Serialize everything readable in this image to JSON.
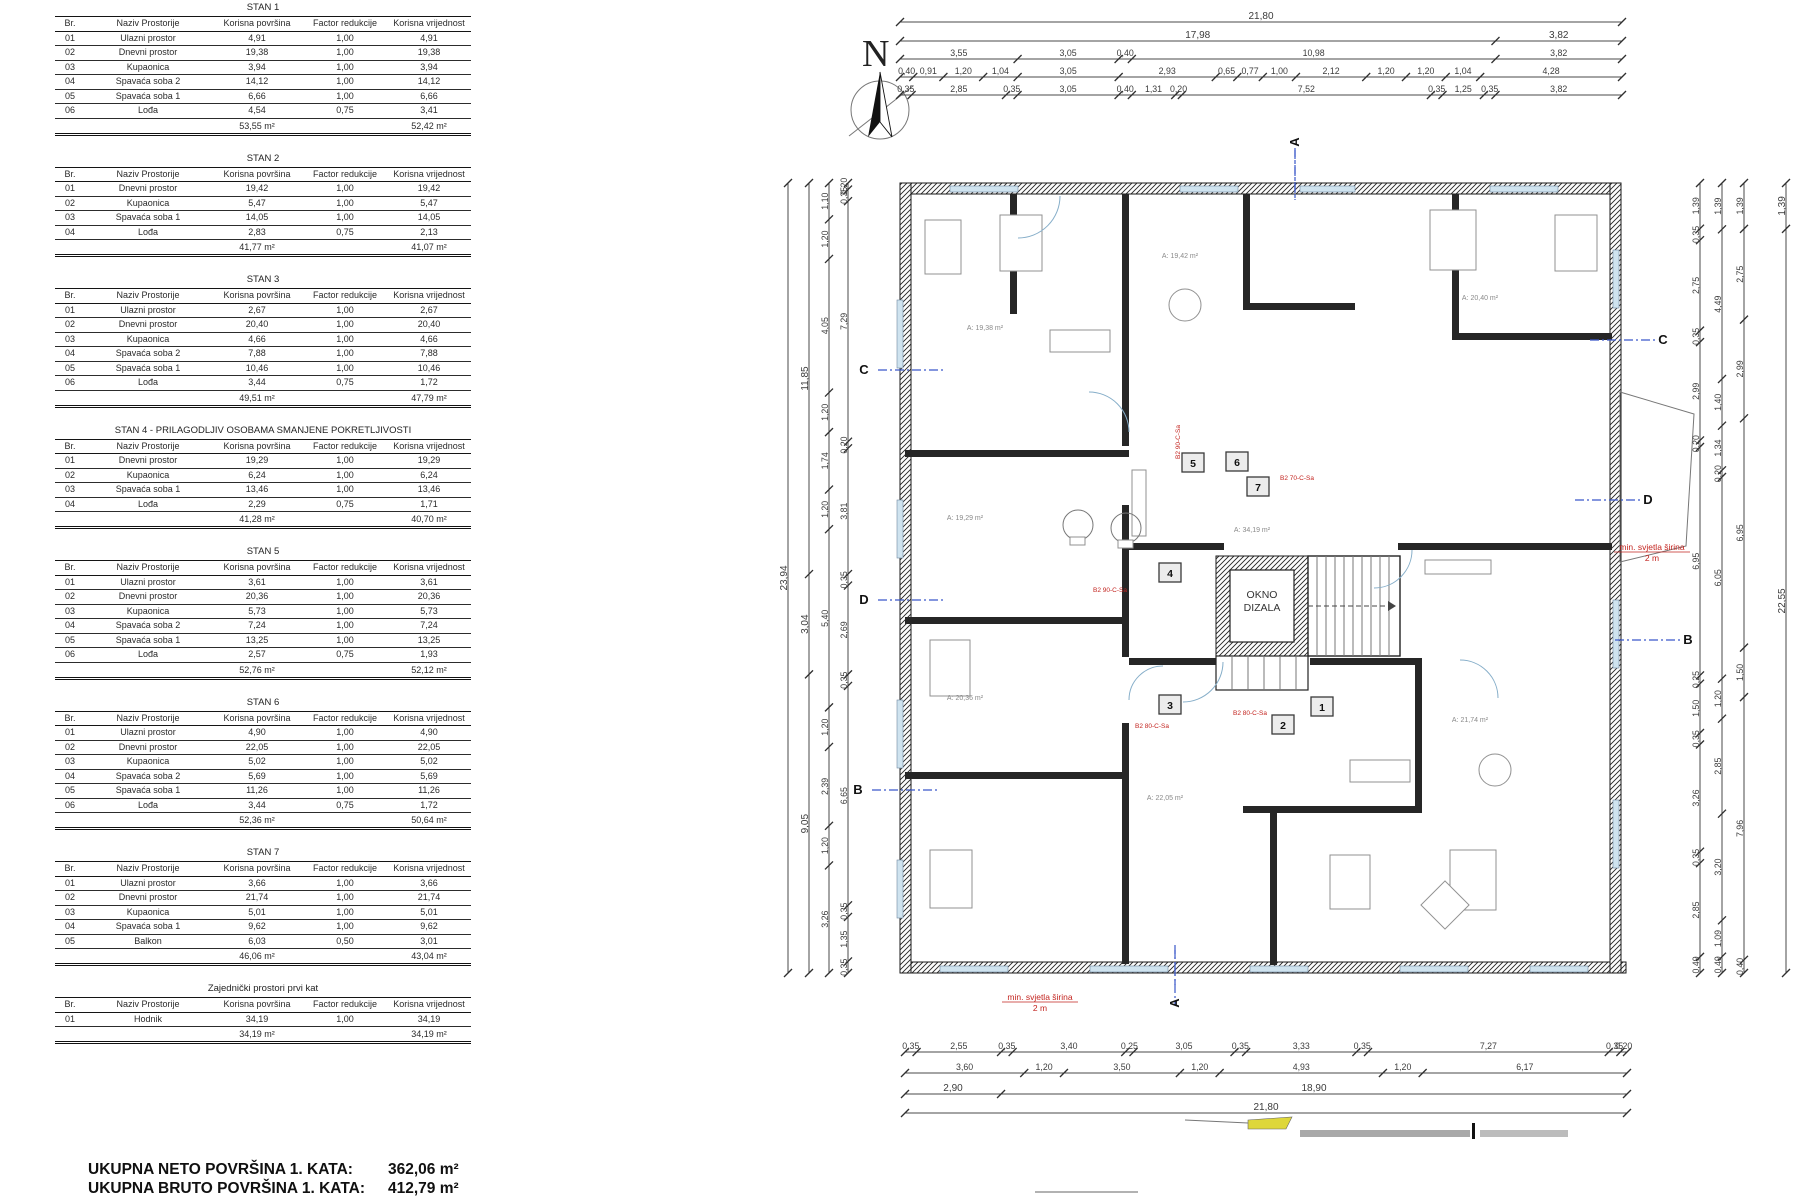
{
  "tables": {
    "headers": [
      "Br.",
      "Naziv Prostorije",
      "Korisna površina",
      "Factor redukcije",
      "Korisna vrijednost"
    ],
    "groups": [
      {
        "title": "STAN 1",
        "rows": [
          [
            "01",
            "Ulazni prostor",
            "4,91",
            "1,00",
            "4,91"
          ],
          [
            "02",
            "Dnevni prostor",
            "19,38",
            "1,00",
            "19,38"
          ],
          [
            "03",
            "Kupaonica",
            "3,94",
            "1,00",
            "3,94"
          ],
          [
            "04",
            "Spavaća soba 2",
            "14,12",
            "1,00",
            "14,12"
          ],
          [
            "05",
            "Spavaća soba 1",
            "6,66",
            "1,00",
            "6,66"
          ],
          [
            "06",
            "Lođa",
            "4,54",
            "0,75",
            "3,41"
          ]
        ],
        "total_area": "53,55 m²",
        "total_value": "52,42 m²"
      },
      {
        "title": "STAN 2",
        "rows": [
          [
            "01",
            "Dnevni prostor",
            "19,42",
            "1,00",
            "19,42"
          ],
          [
            "02",
            "Kupaonica",
            "5,47",
            "1,00",
            "5,47"
          ],
          [
            "03",
            "Spavaća soba 1",
            "14,05",
            "1,00",
            "14,05"
          ],
          [
            "04",
            "Lođa",
            "2,83",
            "0,75",
            "2,13"
          ]
        ],
        "total_area": "41,77 m²",
        "total_value": "41,07 m²"
      },
      {
        "title": "STAN 3",
        "rows": [
          [
            "01",
            "Ulazni prostor",
            "2,67",
            "1,00",
            "2,67"
          ],
          [
            "02",
            "Dnevni prostor",
            "20,40",
            "1,00",
            "20,40"
          ],
          [
            "03",
            "Kupaonica",
            "4,66",
            "1,00",
            "4,66"
          ],
          [
            "04",
            "Spavaća soba 2",
            "7,88",
            "1,00",
            "7,88"
          ],
          [
            "05",
            "Spavaća soba 1",
            "10,46",
            "1,00",
            "10,46"
          ],
          [
            "06",
            "Lođa",
            "3,44",
            "0,75",
            "1,72"
          ]
        ],
        "total_area": "49,51 m²",
        "total_value": "47,79 m²"
      },
      {
        "title": "STAN 4 - PRILAGODLJIV OSOBAMA SMANJENE POKRETLJIVOSTI",
        "rows": [
          [
            "01",
            "Dnevni prostor",
            "19,29",
            "1,00",
            "19,29"
          ],
          [
            "02",
            "Kupaonica",
            "6,24",
            "1,00",
            "6,24"
          ],
          [
            "03",
            "Spavaća soba 1",
            "13,46",
            "1,00",
            "13,46"
          ],
          [
            "04",
            "Lođa",
            "2,29",
            "0,75",
            "1,71"
          ]
        ],
        "total_area": "41,28 m²",
        "total_value": "40,70 m²"
      },
      {
        "title": "STAN 5",
        "rows": [
          [
            "01",
            "Ulazni prostor",
            "3,61",
            "1,00",
            "3,61"
          ],
          [
            "02",
            "Dnevni prostor",
            "20,36",
            "1,00",
            "20,36"
          ],
          [
            "03",
            "Kupaonica",
            "5,73",
            "1,00",
            "5,73"
          ],
          [
            "04",
            "Spavaća soba 2",
            "7,24",
            "1,00",
            "7,24"
          ],
          [
            "05",
            "Spavaća soba 1",
            "13,25",
            "1,00",
            "13,25"
          ],
          [
            "06",
            "Lođa",
            "2,57",
            "0,75",
            "1,93"
          ]
        ],
        "total_area": "52,76 m²",
        "total_value": "52,12 m²"
      },
      {
        "title": "STAN 6",
        "rows": [
          [
            "01",
            "Ulazni prostor",
            "4,90",
            "1,00",
            "4,90"
          ],
          [
            "02",
            "Dnevni prostor",
            "22,05",
            "1,00",
            "22,05"
          ],
          [
            "03",
            "Kupaonica",
            "5,02",
            "1,00",
            "5,02"
          ],
          [
            "04",
            "Spavaća soba 2",
            "5,69",
            "1,00",
            "5,69"
          ],
          [
            "05",
            "Spavaća soba 1",
            "11,26",
            "1,00",
            "11,26"
          ],
          [
            "06",
            "Lođa",
            "3,44",
            "0,75",
            "1,72"
          ]
        ],
        "total_area": "52,36 m²",
        "total_value": "50,64 m²"
      },
      {
        "title": "STAN 7",
        "rows": [
          [
            "01",
            "Ulazni prostor",
            "3,66",
            "1,00",
            "3,66"
          ],
          [
            "02",
            "Dnevni prostor",
            "21,74",
            "1,00",
            "21,74"
          ],
          [
            "03",
            "Kupaonica",
            "5,01",
            "1,00",
            "5,01"
          ],
          [
            "04",
            "Spavaća soba 1",
            "9,62",
            "1,00",
            "9,62"
          ],
          [
            "05",
            "Balkon",
            "6,03",
            "0,50",
            "3,01"
          ]
        ],
        "total_area": "46,06 m²",
        "total_value": "43,04 m²"
      },
      {
        "title": "Zajednički prostori prvi kat",
        "rows": [
          [
            "01",
            "Hodnik",
            "34,19",
            "1,00",
            "34,19"
          ]
        ],
        "total_area": "34,19 m²",
        "total_value": "34,19 m²"
      }
    ]
  },
  "summary": {
    "neto_label": "UKUPNA NETO POVRŠINA 1. KATA:",
    "neto_value": "362,06 m²",
    "bruto_label": "UKUPNA BRUTO POVRŠINA 1. KATA:",
    "bruto_value": "412,79 m²"
  },
  "plan": {
    "north_label": "N",
    "elevator_label_line1": "OKNO",
    "elevator_label_line2": "DIZALA",
    "unit_badges": [
      {
        "n": "1",
        "x": 1322,
        "y": 709
      },
      {
        "n": "2",
        "x": 1283,
        "y": 727
      },
      {
        "n": "3",
        "x": 1170,
        "y": 707
      },
      {
        "n": "4",
        "x": 1170,
        "y": 575
      },
      {
        "n": "5",
        "x": 1193,
        "y": 465
      },
      {
        "n": "6",
        "x": 1237,
        "y": 464
      },
      {
        "n": "7",
        "x": 1258,
        "y": 489
      }
    ],
    "section_markers": [
      {
        "label": "C",
        "x": 878,
        "y": 370,
        "dir": "left"
      },
      {
        "label": "D",
        "x": 878,
        "y": 600,
        "dir": "left"
      },
      {
        "label": "B",
        "x": 872,
        "y": 790,
        "dir": "left"
      },
      {
        "label": "C",
        "x": 1655,
        "y": 340,
        "dir": "right"
      },
      {
        "label": "D",
        "x": 1640,
        "y": 500,
        "dir": "right"
      },
      {
        "label": "B",
        "x": 1680,
        "y": 640,
        "dir": "right"
      },
      {
        "label": "A",
        "x": 1295,
        "y": 150,
        "dir": "top"
      },
      {
        "label": "A",
        "x": 1175,
        "y": 985,
        "dir": "bottom"
      }
    ],
    "red_notes": [
      {
        "line1": "min. svjetla širina",
        "line2": "2 m",
        "x": 1040,
        "y": 1000
      },
      {
        "line1": "min. svjetla širina",
        "line2": "2 m",
        "x": 1652,
        "y": 550
      }
    ],
    "door_labels": [
      {
        "t": "B2 90-C-Sa",
        "x": 1110,
        "y": 592,
        "rot": 0
      },
      {
        "t": "B2 70-C-Sa",
        "x": 1297,
        "y": 480,
        "rot": 0
      },
      {
        "t": "B2 80-C-Sa",
        "x": 1152,
        "y": 728,
        "rot": 0
      },
      {
        "t": "B2 80-C-Sa",
        "x": 1250,
        "y": 715,
        "rot": 0
      },
      {
        "t": "B2 90-C-Sa",
        "x": 1180,
        "y": 442,
        "rot": -90
      }
    ],
    "room_labels": [
      {
        "t": "A: 19,38 m²",
        "x": 985,
        "y": 330
      },
      {
        "t": "A: 19,42 m²",
        "x": 1180,
        "y": 258
      },
      {
        "t": "A: 20,40 m²",
        "x": 1480,
        "y": 300
      },
      {
        "t": "A: 19,29 m²",
        "x": 965,
        "y": 520
      },
      {
        "t": "A: 20,36 m²",
        "x": 965,
        "y": 700
      },
      {
        "t": "A: 34,19 m²",
        "x": 1252,
        "y": 532
      },
      {
        "t": "A: 22,05 m²",
        "x": 1165,
        "y": 800
      },
      {
        "t": "A: 21,74 m²",
        "x": 1470,
        "y": 722
      }
    ],
    "dims": {
      "top": {
        "x0": 900,
        "x1": 1622,
        "rows": [
          {
            "y": 22,
            "vals": [
              "21,80"
            ]
          },
          {
            "y": 41,
            "vals": [
              "17,98",
              "3,82"
            ]
          },
          {
            "y": 59,
            "vals": [
              "3,55",
              "3,05",
              "0,40",
              "10,98",
              "3,82"
            ]
          },
          {
            "y": 77,
            "vals": [
              "0,40",
              "0,91",
              "1,20",
              "1,04",
              "3,05",
              "2,93",
              "0,65",
              "0,77",
              "1,00",
              "2,12",
              "1,20",
              "1,20",
              "1,04",
              "4,28"
            ]
          },
          {
            "y": 95,
            "vals": [
              "0,35",
              "2,85",
              "0,35",
              "3,05",
              "0,40",
              "1,31",
              "0,20",
              "7,52",
              "0,35",
              "1,25",
              "0,35",
              "3,82"
            ]
          }
        ]
      },
      "bottom": {
        "x0": 905,
        "x1": 1627,
        "rows": [
          {
            "y": 1052,
            "vals": [
              "0,35",
              "2,55",
              "0,35",
              "3,40",
              "0,25",
              "3,05",
              "0,35",
              "3,33",
              "0,35",
              "7,27",
              "0,35",
              "0,20"
            ]
          },
          {
            "y": 1073,
            "vals": [
              "3,60",
              "1,20",
              "3,50",
              "1,20",
              "4,93",
              "1,20",
              "6,17"
            ]
          },
          {
            "y": 1094,
            "vals": [
              "2,90",
              "18,90"
            ]
          },
          {
            "y": 1113,
            "vals": [
              "21,80"
            ]
          }
        ]
      },
      "left": {
        "y0": 183,
        "y1": 973,
        "cols": [
          {
            "x": 788,
            "vals": [
              "23,94"
            ]
          },
          {
            "x": 809,
            "vals": [
              "11,85",
              "3,04",
              "9,05"
            ]
          },
          {
            "x": 829,
            "vals": [
              "1,10",
              "1,20",
              "4,05",
              "1,20",
              "1,74",
              "1,20",
              "5,40",
              "1,20",
              "2,39",
              "1,20",
              "3,26"
            ]
          },
          {
            "x": 848,
            "vals": [
              "0,20",
              "0,35",
              "7,29",
              "0,20",
              "3,81",
              "0,35",
              "2,69",
              "0,35",
              "6,65",
              "0,35",
              "1,35",
              "0,35"
            ]
          }
        ]
      },
      "right": {
        "y0": 183,
        "y1": 973,
        "cols": [
          {
            "x": 1700,
            "vals": [
              "1,39",
              "0,35",
              "2,75",
              "0,35",
              "2,99",
              "0,20",
              "6,95",
              "0,25",
              "1,50",
              "0,35",
              "3,26",
              "0,35",
              "2,85",
              "0,49"
            ]
          },
          {
            "x": 1722,
            "vals": [
              "1,39",
              "4,49",
              "1,40",
              "1,34",
              "0,20",
              "6,05",
              "1,20",
              "2,85",
              "3,20",
              "1,09",
              "0,49"
            ]
          },
          {
            "x": 1744,
            "vals": [
              "1,39",
              "2,75",
              "2,99",
              "6,95",
              "1,50",
              "7,96",
              "0,40"
            ]
          },
          {
            "x": 1786,
            "vals": [
              "1,39",
              "22,55"
            ]
          }
        ]
      }
    },
    "colors": {
      "wall": "#1a1a1a",
      "dim": "#4a4a4a",
      "red": "#c3241f",
      "section_blue": "#3a57c9",
      "window": "#cfe3ef",
      "highlight_yellow": "#ded73a"
    }
  }
}
